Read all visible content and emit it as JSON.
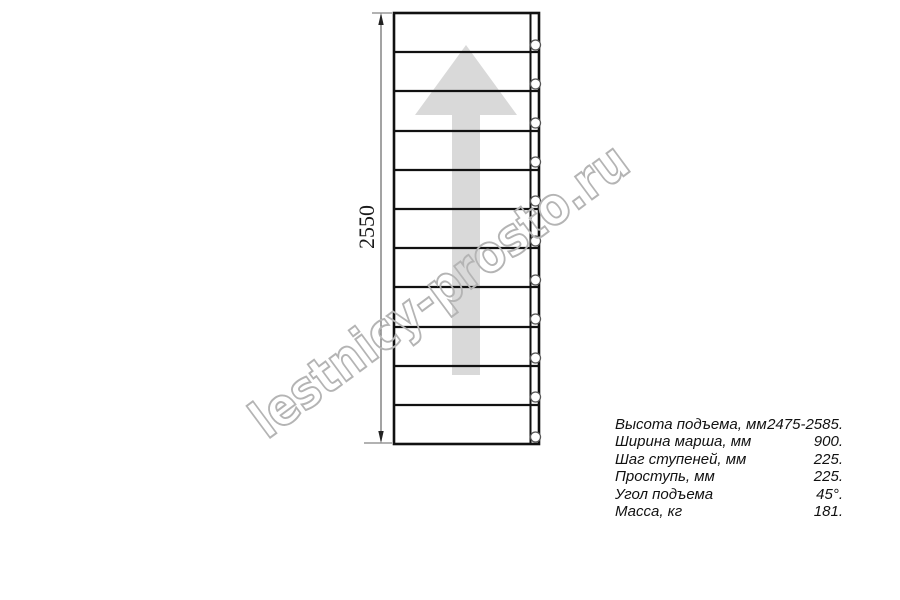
{
  "drawing": {
    "title": "staircase-straight-flight-plan",
    "dimension_label": "2550",
    "treads_count": 11,
    "bolt_circles_count": 11,
    "arrow_direction": "up",
    "colors": {
      "line": "#111111",
      "dimension_line": "#666666",
      "arrow_fill": "#d9d9d9",
      "watermark_outline": "#b4b4b4",
      "text": "#111111"
    }
  },
  "watermark": {
    "text": "lestnicy-prosto.ru"
  },
  "specs": {
    "rows": [
      {
        "label": "Высота подъема, мм",
        "value": "2475-2585."
      },
      {
        "label": "Ширина марша, мм",
        "value": "900."
      },
      {
        "label": "Шаг ступеней, мм",
        "value": "225."
      },
      {
        "label": "Проступь, мм",
        "value": "225."
      },
      {
        "label": "Угол подъема",
        "value": "45°."
      },
      {
        "label": "Масса, кг",
        "value": "181."
      }
    ]
  }
}
